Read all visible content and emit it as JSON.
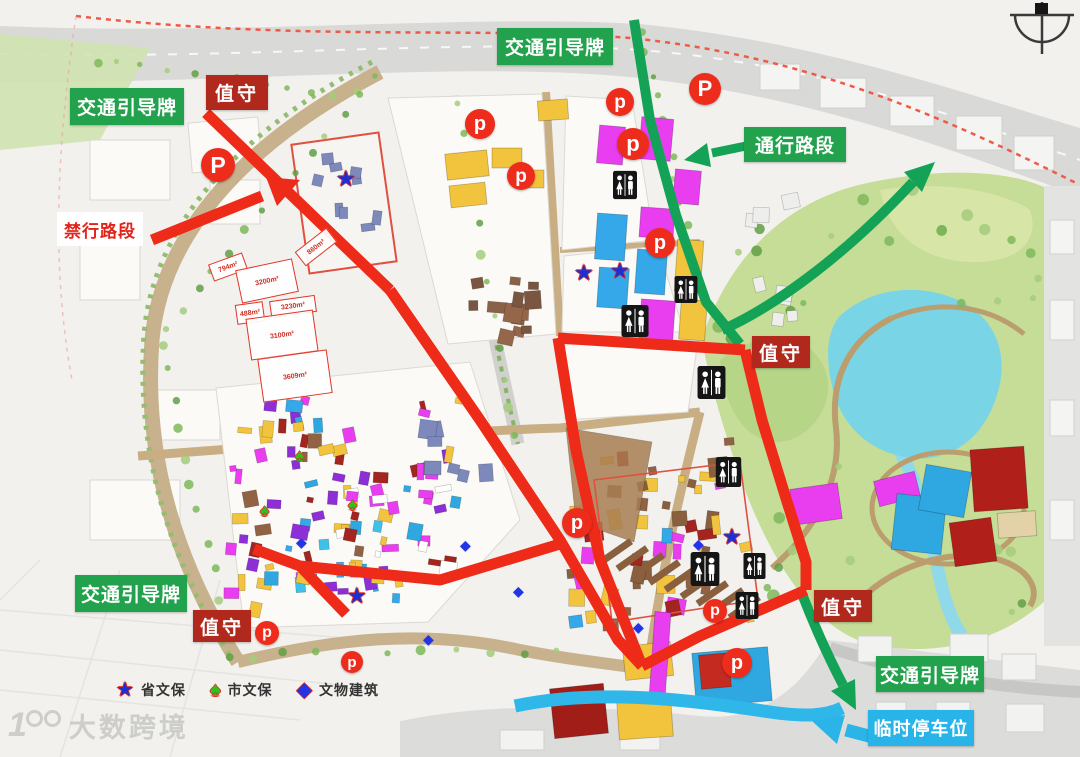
{
  "glyphs": {
    "star": "★",
    "spade": "♠",
    "diamond": "◆"
  },
  "colors": {
    "route_red": "#ee2a18",
    "route_green": "#14a356",
    "label_green": "#23a24d",
    "label_red": "#b1281c",
    "cyan": "#29b4e9",
    "p_marker_red": "#ee2c1c"
  },
  "labels": [
    {
      "id": "sign-top",
      "text": "交通引导牌",
      "style": "green",
      "x": 497,
      "y": 28,
      "w": 116,
      "h": 37
    },
    {
      "id": "duty-top",
      "text": "值守",
      "style": "red",
      "x": 206,
      "y": 75,
      "w": 62,
      "h": 35
    },
    {
      "id": "sign-left",
      "text": "交通引导牌",
      "style": "green",
      "x": 70,
      "y": 88,
      "w": 114,
      "h": 37
    },
    {
      "id": "no-entry-road",
      "text": "禁行路段",
      "style": "white-red",
      "x": 57,
      "y": 212,
      "w": 86,
      "h": 34
    },
    {
      "id": "open-road",
      "text": "通行路段",
      "style": "green",
      "x": 744,
      "y": 127,
      "w": 102,
      "h": 35
    },
    {
      "id": "duty-middle",
      "text": "值守",
      "style": "red",
      "x": 752,
      "y": 336,
      "w": 58,
      "h": 32
    },
    {
      "id": "duty-right",
      "text": "值守",
      "style": "red",
      "x": 814,
      "y": 590,
      "w": 58,
      "h": 32
    },
    {
      "id": "sign-bottom-left",
      "text": "交通引导牌",
      "style": "green",
      "x": 75,
      "y": 575,
      "w": 112,
      "h": 37
    },
    {
      "id": "duty-bottom-left",
      "text": "值守",
      "style": "red",
      "x": 193,
      "y": 610,
      "w": 58,
      "h": 32
    },
    {
      "id": "sign-bottom-right",
      "text": "交通引导牌",
      "style": "green",
      "x": 876,
      "y": 656,
      "w": 108,
      "h": 36
    },
    {
      "id": "temp-parking",
      "text": "临时停车位",
      "style": "cyan",
      "x": 868,
      "y": 710,
      "w": 106,
      "h": 36
    }
  ],
  "p_markers": [
    {
      "x": 218,
      "y": 165,
      "r": 17,
      "letter": "P"
    },
    {
      "x": 480,
      "y": 124,
      "r": 15,
      "letter": "p"
    },
    {
      "x": 521,
      "y": 176,
      "r": 14,
      "letter": "p"
    },
    {
      "x": 620,
      "y": 102,
      "r": 14,
      "letter": "p"
    },
    {
      "x": 705,
      "y": 89,
      "r": 16,
      "letter": "P"
    },
    {
      "x": 633,
      "y": 144,
      "r": 16,
      "letter": "p"
    },
    {
      "x": 660,
      "y": 243,
      "r": 15,
      "letter": "p"
    },
    {
      "x": 577,
      "y": 523,
      "r": 15,
      "letter": "p"
    },
    {
      "x": 715,
      "y": 611,
      "r": 12,
      "letter": "p"
    },
    {
      "x": 737,
      "y": 663,
      "r": 15,
      "letter": "p"
    },
    {
      "x": 267,
      "y": 633,
      "r": 12,
      "letter": "p"
    },
    {
      "x": 352,
      "y": 662,
      "r": 11,
      "letter": "p"
    }
  ],
  "toilets": [
    {
      "x": 613,
      "y": 170,
      "w": 24,
      "h": 30
    },
    {
      "x": 620,
      "y": 305,
      "w": 30,
      "h": 32
    },
    {
      "x": 673,
      "y": 276,
      "w": 26,
      "h": 27
    },
    {
      "x": 697,
      "y": 366,
      "w": 29,
      "h": 33
    },
    {
      "x": 712,
      "y": 457,
      "w": 33,
      "h": 30
    },
    {
      "x": 690,
      "y": 552,
      "w": 30,
      "h": 34
    },
    {
      "x": 741,
      "y": 553,
      "w": 27,
      "h": 26
    },
    {
      "x": 733,
      "y": 592,
      "w": 28,
      "h": 27
    }
  ],
  "stars": [
    {
      "x": 347,
      "y": 181
    },
    {
      "x": 585,
      "y": 275
    },
    {
      "x": 621,
      "y": 273
    },
    {
      "x": 733,
      "y": 539
    },
    {
      "x": 358,
      "y": 598
    }
  ],
  "spades": [
    {
      "x": 356,
      "y": 506
    },
    {
      "x": 303,
      "y": 457
    },
    {
      "x": 268,
      "y": 512
    }
  ],
  "diamonds": [
    {
      "x": 467,
      "y": 546
    },
    {
      "x": 303,
      "y": 543
    },
    {
      "x": 430,
      "y": 640
    },
    {
      "x": 520,
      "y": 592
    },
    {
      "x": 640,
      "y": 628
    },
    {
      "x": 700,
      "y": 545
    }
  ],
  "area_boxes": [
    {
      "text": "794m²",
      "x": 210,
      "y": 258,
      "w": 36,
      "h": 18,
      "rot": -20
    },
    {
      "text": "3200m²",
      "x": 238,
      "y": 264,
      "w": 58,
      "h": 34,
      "rot": -12
    },
    {
      "text": "860m²",
      "x": 296,
      "y": 238,
      "w": 40,
      "h": 18,
      "rot": -38
    },
    {
      "text": "488m²",
      "x": 236,
      "y": 303,
      "w": 28,
      "h": 20,
      "rot": -8
    },
    {
      "text": "3230m²",
      "x": 270,
      "y": 298,
      "w": 46,
      "h": 17,
      "rot": -8
    },
    {
      "text": "3100m²",
      "x": 248,
      "y": 314,
      "w": 68,
      "h": 42,
      "rot": -8
    },
    {
      "text": "3609m²",
      "x": 260,
      "y": 354,
      "w": 70,
      "h": 44,
      "rot": -8
    }
  ],
  "legend": {
    "items": [
      {
        "icon": "star-icon",
        "glyph": "★",
        "color": "#1f2ed0",
        "label": "省文保"
      },
      {
        "icon": "spade-icon",
        "glyph": "♠",
        "color": "#2bc41f",
        "label": "市文保"
      },
      {
        "icon": "diamond-icon",
        "glyph": "◆",
        "color": "#2334e4",
        "label": "文物建筑"
      }
    ]
  },
  "watermark": {
    "text": "大数跨境"
  }
}
